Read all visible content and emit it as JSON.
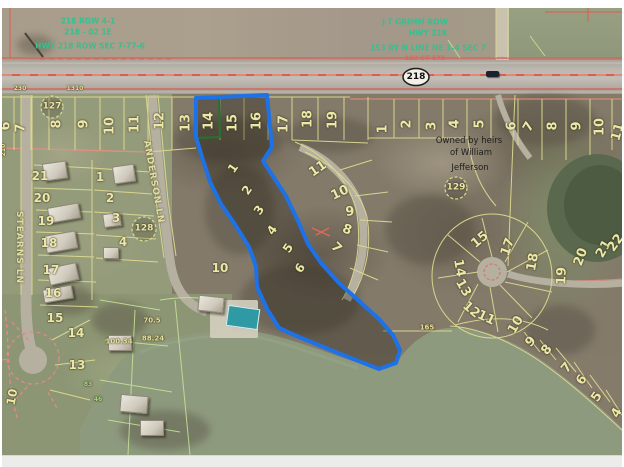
{
  "map_title": "county-parcel-aerial-viewer",
  "route_shield": "218",
  "owner_note": {
    "line1": "Owned by heirs",
    "line2": "of William",
    "line3": "Jefferson"
  },
  "streets": {
    "anderson": "ANDERSON LN",
    "stearns": "STEARNS LN"
  },
  "green_note_left": {
    "line1": "218 RGW 4-1",
    "line2": "218 - 02 1E",
    "line3": "HWY 218 ROW SEC 7-77-6"
  },
  "green_note_mid": {
    "line1": "J T GRIMM ROW",
    "line2": "HWY 218",
    "line3": "153 RY  N LINE NE 1-4 SEC 7",
    "line4": "123 ST 575"
  },
  "parcel_circles": [
    {
      "t": "127",
      "x": 52,
      "y": 107
    },
    {
      "t": "128",
      "x": 144,
      "y": 229
    },
    {
      "t": "129",
      "x": 456,
      "y": 188
    }
  ],
  "colors": {
    "lot": "#ece8a8",
    "dim": "#e6e29a",
    "greennum": "#a8d88a",
    "note": "#35c08f",
    "rednote": "#d96a5a",
    "highlight_blue": "#1e72e8",
    "selected_green": "#27a03c",
    "parcel_line": "#ded98f",
    "road_red": "#d4584a"
  },
  "labels": [
    {
      "t": "6",
      "x": 6,
      "y": 126,
      "r": -90
    },
    {
      "t": "7",
      "x": 21,
      "y": 128,
      "r": -90
    },
    {
      "t": "8",
      "x": 57,
      "y": 124,
      "r": -90
    },
    {
      "t": "9",
      "x": 84,
      "y": 124,
      "r": -90
    },
    {
      "t": "10",
      "x": 110,
      "y": 126,
      "r": -90
    },
    {
      "t": "11",
      "x": 135,
      "y": 124,
      "r": -90
    },
    {
      "t": "12",
      "x": 160,
      "y": 121,
      "r": -90
    },
    {
      "t": "13",
      "x": 186,
      "y": 123,
      "r": -90
    },
    {
      "t": "14",
      "x": 209,
      "y": 121,
      "r": -90
    },
    {
      "t": "15",
      "x": 233,
      "y": 123,
      "r": -90
    },
    {
      "t": "16",
      "x": 257,
      "y": 121,
      "r": -90
    },
    {
      "t": "17",
      "x": 284,
      "y": 124,
      "r": -90
    },
    {
      "t": "18",
      "x": 308,
      "y": 119,
      "r": -90
    },
    {
      "t": "19",
      "x": 333,
      "y": 120,
      "r": -90
    },
    {
      "t": "1",
      "x": 383,
      "y": 129,
      "r": -90
    },
    {
      "t": "2",
      "x": 407,
      "y": 124,
      "r": -90
    },
    {
      "t": "3",
      "x": 432,
      "y": 126,
      "r": -90
    },
    {
      "t": "4",
      "x": 455,
      "y": 124,
      "r": -90
    },
    {
      "t": "5",
      "x": 480,
      "y": 124,
      "r": -90
    },
    {
      "t": "6",
      "x": 512,
      "y": 126,
      "r": -90
    },
    {
      "t": "7",
      "x": 529,
      "y": 127,
      "r": -60
    },
    {
      "t": "8",
      "x": 553,
      "y": 126,
      "r": -90
    },
    {
      "t": "9",
      "x": 577,
      "y": 126,
      "r": -90
    },
    {
      "t": "10",
      "x": 600,
      "y": 127,
      "r": -90
    },
    {
      "t": "11",
      "x": 618,
      "y": 132,
      "r": -75
    },
    {
      "t": "1",
      "x": 233,
      "y": 168,
      "r": -55,
      "s": 12
    },
    {
      "t": "2",
      "x": 247,
      "y": 190,
      "r": -55,
      "s": 12
    },
    {
      "t": "3",
      "x": 259,
      "y": 210,
      "r": -55,
      "s": 12
    },
    {
      "t": "4",
      "x": 272,
      "y": 230,
      "r": -55,
      "s": 12
    },
    {
      "t": "5",
      "x": 288,
      "y": 248,
      "r": -55,
      "s": 12
    },
    {
      "t": "6",
      "x": 300,
      "y": 268,
      "r": -55,
      "s": 12
    },
    {
      "t": "11",
      "x": 318,
      "y": 169,
      "r": -35
    },
    {
      "t": "10",
      "x": 340,
      "y": 193,
      "r": -25
    },
    {
      "t": "9",
      "x": 350,
      "y": 212,
      "r": -5
    },
    {
      "t": "8",
      "x": 347,
      "y": 230,
      "r": 20
    },
    {
      "t": "7",
      "x": 336,
      "y": 248,
      "r": 45
    },
    {
      "t": "21",
      "x": 40,
      "y": 176,
      "s": 12
    },
    {
      "t": "20",
      "x": 42,
      "y": 198,
      "s": 12
    },
    {
      "t": "19",
      "x": 46,
      "y": 221,
      "s": 12
    },
    {
      "t": "18",
      "x": 49,
      "y": 243,
      "s": 12
    },
    {
      "t": "17",
      "x": 51,
      "y": 270,
      "s": 12
    },
    {
      "t": "16",
      "x": 53,
      "y": 293,
      "s": 12
    },
    {
      "t": "15",
      "x": 55,
      "y": 318,
      "s": 12
    },
    {
      "t": "14",
      "x": 76,
      "y": 333,
      "s": 12
    },
    {
      "t": "13",
      "x": 77,
      "y": 365,
      "s": 12
    },
    {
      "t": "10",
      "x": 12,
      "y": 397,
      "r": -80,
      "s": 12
    },
    {
      "t": "1",
      "x": 100,
      "y": 177,
      "s": 12
    },
    {
      "t": "2",
      "x": 110,
      "y": 198,
      "s": 12
    },
    {
      "t": "3",
      "x": 116,
      "y": 218,
      "s": 12
    },
    {
      "t": "4",
      "x": 123,
      "y": 242,
      "s": 12
    },
    {
      "t": "10",
      "x": 220,
      "y": 268,
      "s": 12
    },
    {
      "t": "15",
      "x": 480,
      "y": 240,
      "r": -40
    },
    {
      "t": "17",
      "x": 508,
      "y": 247,
      "r": -70
    },
    {
      "t": "18",
      "x": 533,
      "y": 262,
      "r": -80
    },
    {
      "t": "19",
      "x": 562,
      "y": 276,
      "r": -88
    },
    {
      "t": "20",
      "x": 581,
      "y": 257,
      "r": -70
    },
    {
      "t": "21",
      "x": 604,
      "y": 249,
      "r": -60
    },
    {
      "t": "22",
      "x": 616,
      "y": 243,
      "r": -55
    },
    {
      "t": "14",
      "x": 459,
      "y": 268,
      "r": 80
    },
    {
      "t": "13",
      "x": 463,
      "y": 288,
      "r": 60
    },
    {
      "t": "12",
      "x": 471,
      "y": 310,
      "r": 40
    },
    {
      "t": "11",
      "x": 486,
      "y": 318,
      "r": 25
    },
    {
      "t": "10",
      "x": 516,
      "y": 325,
      "r": -60
    },
    {
      "t": "9",
      "x": 531,
      "y": 342,
      "r": -45
    },
    {
      "t": "8",
      "x": 547,
      "y": 350,
      "r": -50
    },
    {
      "t": "7",
      "x": 567,
      "y": 368,
      "r": -50
    },
    {
      "t": "6",
      "x": 582,
      "y": 380,
      "r": -55
    },
    {
      "t": "5",
      "x": 597,
      "y": 397,
      "r": -55
    },
    {
      "t": "4",
      "x": 617,
      "y": 413,
      "r": -60
    },
    {
      "t": "230",
      "x": 20,
      "y": 89,
      "s": 6,
      "c": "dim",
      "n": "dimension-label"
    },
    {
      "t": "1310",
      "x": 75,
      "y": 89,
      "s": 6,
      "c": "dim",
      "n": "dimension-label"
    },
    {
      "t": "210",
      "x": 4,
      "y": 150,
      "r": -90,
      "s": 6,
      "c": "dim",
      "n": "dimension-label"
    },
    {
      "t": "100.34",
      "x": 119,
      "y": 342,
      "s": 7,
      "c": "dim",
      "n": "dimension-label"
    },
    {
      "t": "88.24",
      "x": 153,
      "y": 339,
      "s": 7,
      "c": "dim",
      "n": "dimension-label"
    },
    {
      "t": "70.5",
      "x": 152,
      "y": 321,
      "s": 7,
      "c": "dim",
      "n": "dimension-label"
    },
    {
      "t": "165",
      "x": 427,
      "y": 328,
      "s": 7,
      "c": "dim",
      "n": "dimension-label"
    },
    {
      "t": "83",
      "x": 88,
      "y": 385,
      "s": 6,
      "c": "greennum",
      "n": "dimension-label"
    },
    {
      "t": "46",
      "x": 98,
      "y": 400,
      "s": 6,
      "c": "greennum",
      "n": "dimension-label"
    }
  ]
}
